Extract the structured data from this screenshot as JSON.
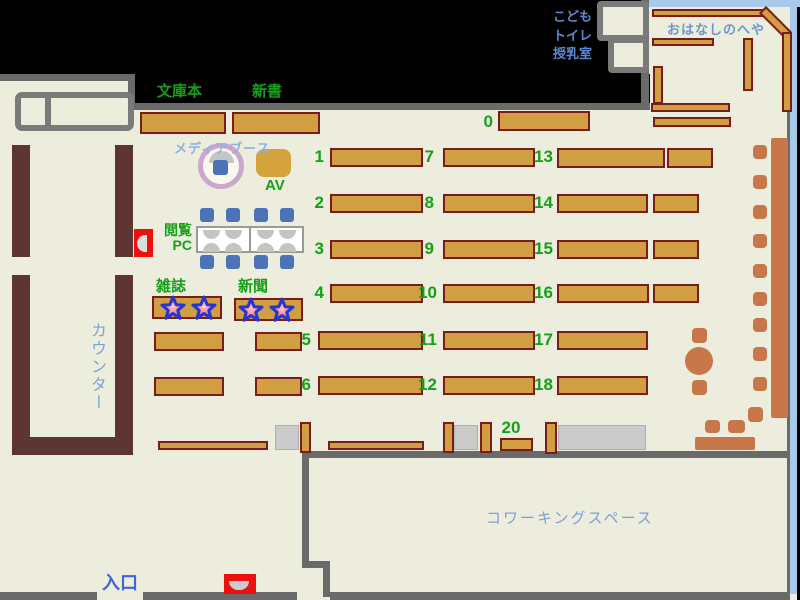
{
  "areas": {
    "bunkobon": "文庫本",
    "shinsho": "新書",
    "media_booth": "メディアブース",
    "av": "AV",
    "reading_pc_line1": "閲覧",
    "reading_pc_line2": "PC",
    "magazines": "雑誌",
    "newspapers": "新聞",
    "counter": "カウンター",
    "entrance": "入口",
    "coworking_space": "コワーキングスペース",
    "kids": "こども",
    "toilet": "トイレ",
    "nursing_room": "授乳室",
    "story_room": "おはなしのへや"
  },
  "numbers": {
    "n0": "0",
    "n1": "1",
    "n2": "2",
    "n3": "3",
    "n4": "4",
    "n5": "5",
    "n6": "6",
    "n7": "7",
    "n8": "8",
    "n9": "9",
    "n10": "10",
    "n11": "11",
    "n12": "12",
    "n13": "13",
    "n14": "14",
    "n15": "15",
    "n16": "16",
    "n17": "17",
    "n18": "18",
    "n20": "20"
  },
  "colors": {
    "floor": "#eceddd",
    "wall_gray": "#6a6a6a",
    "shelf_tan": "#d19e42",
    "shelf_border": "#7b1c1c",
    "counter_brown": "#5d3634",
    "chair_blue": "#4b73b5",
    "furniture_orange": "#c9764a",
    "label_green": "#16a018",
    "label_blue": "#5d89d2",
    "door_red": "#ee0f0f",
    "window_blue": "#a9c9ea",
    "media_ring_purple": "#cda6ce",
    "star_blue": "#2236d6",
    "star_red": "#ef2f3f"
  }
}
